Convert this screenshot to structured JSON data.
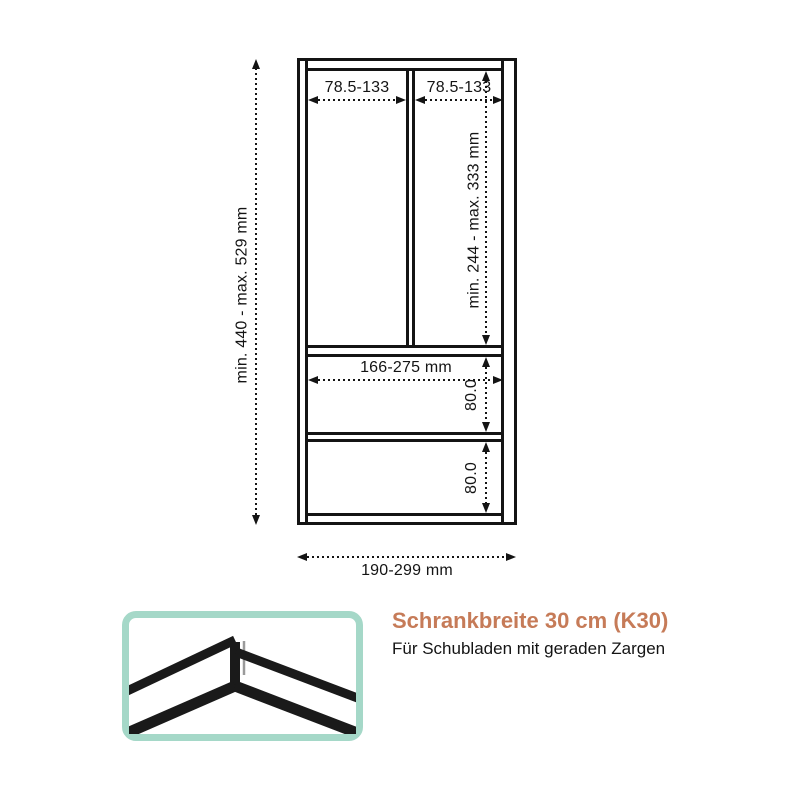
{
  "diagram": {
    "name": "cabinet-drawer-dimension-drawing",
    "labels": {
      "total_height": "min. 440 - max. 529 mm",
      "top_left_inner_width": "78.5-133",
      "top_right_inner_width": "78.5-133",
      "upper_compartment_height": "min. 244 - max. 333 mm",
      "drawer_inner_width": "166-275 mm",
      "upper_drawer_height": "80.0",
      "lower_drawer_height": "80.0",
      "outer_width": "190-299 mm"
    }
  },
  "caption": {
    "title": "Schrankbreite 30 cm (K30)",
    "subtitle": "Für Schubladen mit geraden Zargen"
  },
  "icon": {
    "name": "straight-drawer-sides-corner-icon"
  },
  "colors": {
    "line_black": "#141414",
    "accent_orange": "#c67b58",
    "icon_border_teal": "#a5d8c8",
    "background": "#ffffff"
  }
}
